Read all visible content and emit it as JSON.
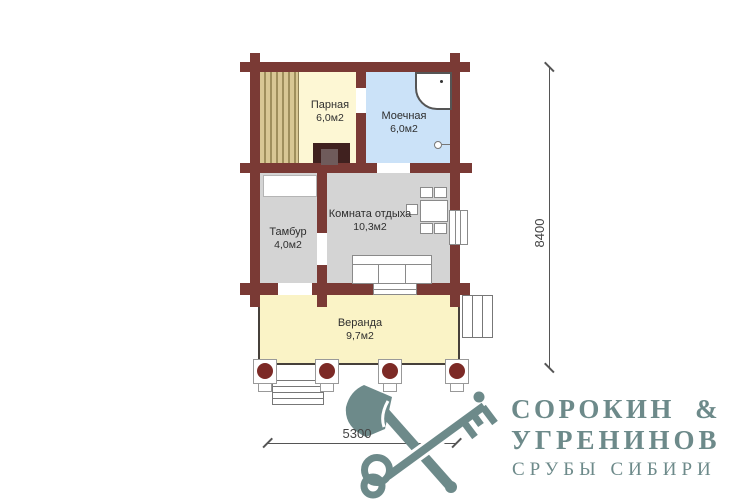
{
  "plan": {
    "rooms": [
      {
        "id": "parnaya",
        "name": "Парная",
        "area": "6,0м2"
      },
      {
        "id": "moechnaya",
        "name": "Моечная",
        "area": "6,0м2"
      },
      {
        "id": "tambur",
        "name": "Тамбур",
        "area": "4,0м2"
      },
      {
        "id": "komnata",
        "name": "Комната отдыха",
        "area": "10,3м2"
      },
      {
        "id": "veranda",
        "name": "Веранда",
        "area": "9,7м2"
      }
    ],
    "dimensions": {
      "vertical": "8400",
      "horizontal": "5300"
    }
  },
  "logo": {
    "name_line1": "СОРОКИН &",
    "name_line2": "УГРЕНИНОВ",
    "tagline": "СРУБЫ СИБИРИ",
    "icons": [
      "axe-icon",
      "key-icon"
    ],
    "color": "#6d8a8a"
  },
  "colors": {
    "walls": "#7a3a35",
    "parnaya_floor": "#fdf7d4",
    "moechnaya_floor": "#cbe2f8",
    "gray_floor": "#d4d4d4",
    "veranda_floor": "#faf3c6",
    "bench": "#d8c794",
    "column_post": "#7c2a26",
    "stove": "#40211f",
    "logo": "#6d8a8a"
  }
}
